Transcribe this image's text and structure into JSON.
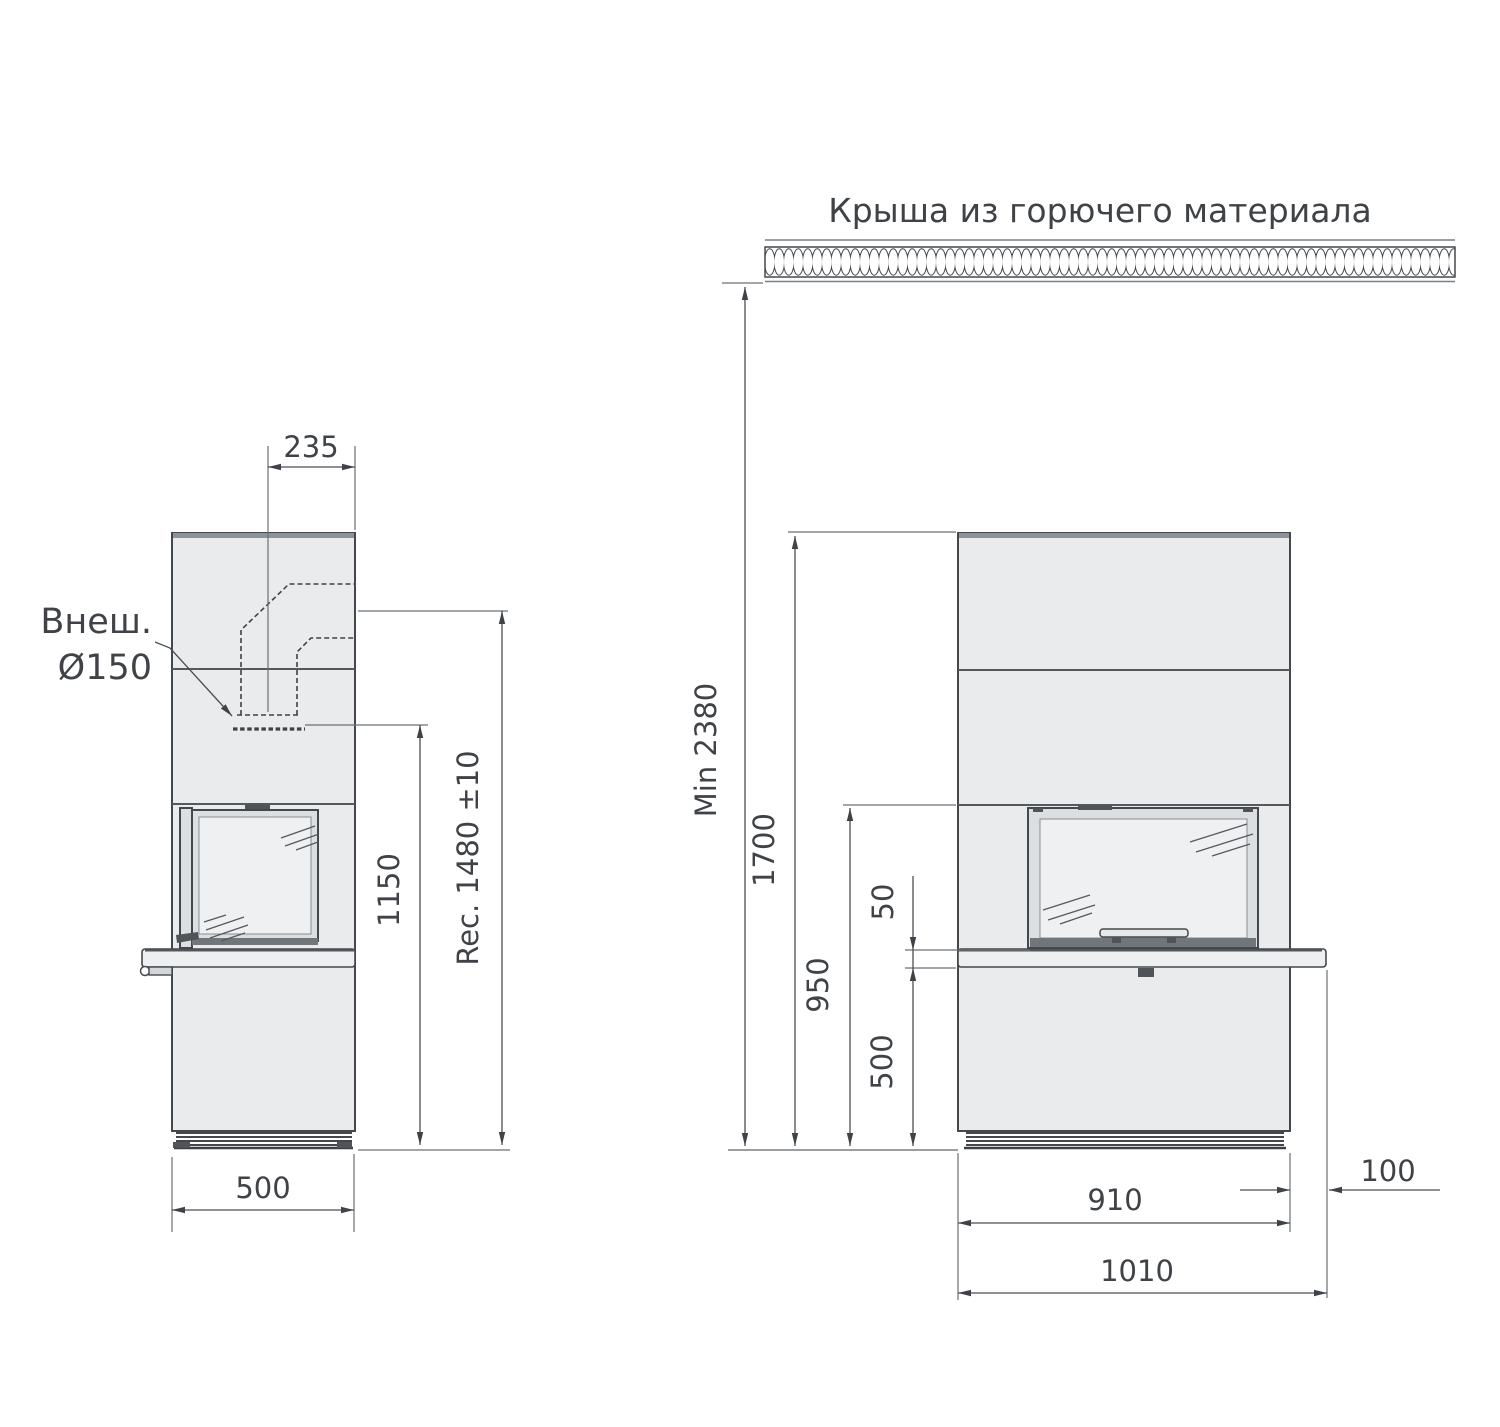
{
  "drawing": {
    "title": "Крыша из горючего материала",
    "flue_label": {
      "line1": "Внеш.",
      "line2": "Ø150"
    },
    "side_view": {
      "flue_offset": "235",
      "connection_height": "1150",
      "recommended_height": "Rec. 1480 ±10",
      "depth": "500"
    },
    "front_view": {
      "ceiling_clearance": "Min 2380",
      "body_height": "1700",
      "opening_top_height": "950",
      "bench_gap": "50",
      "bench_height": "500",
      "body_width": "910",
      "bench_overhang": "100",
      "total_width": "1010"
    },
    "colors": {
      "body_fill": "#e9ebec",
      "outline": "#44484d",
      "dimension_text": "#3f4347",
      "cap_strip": "#8e9399"
    }
  }
}
